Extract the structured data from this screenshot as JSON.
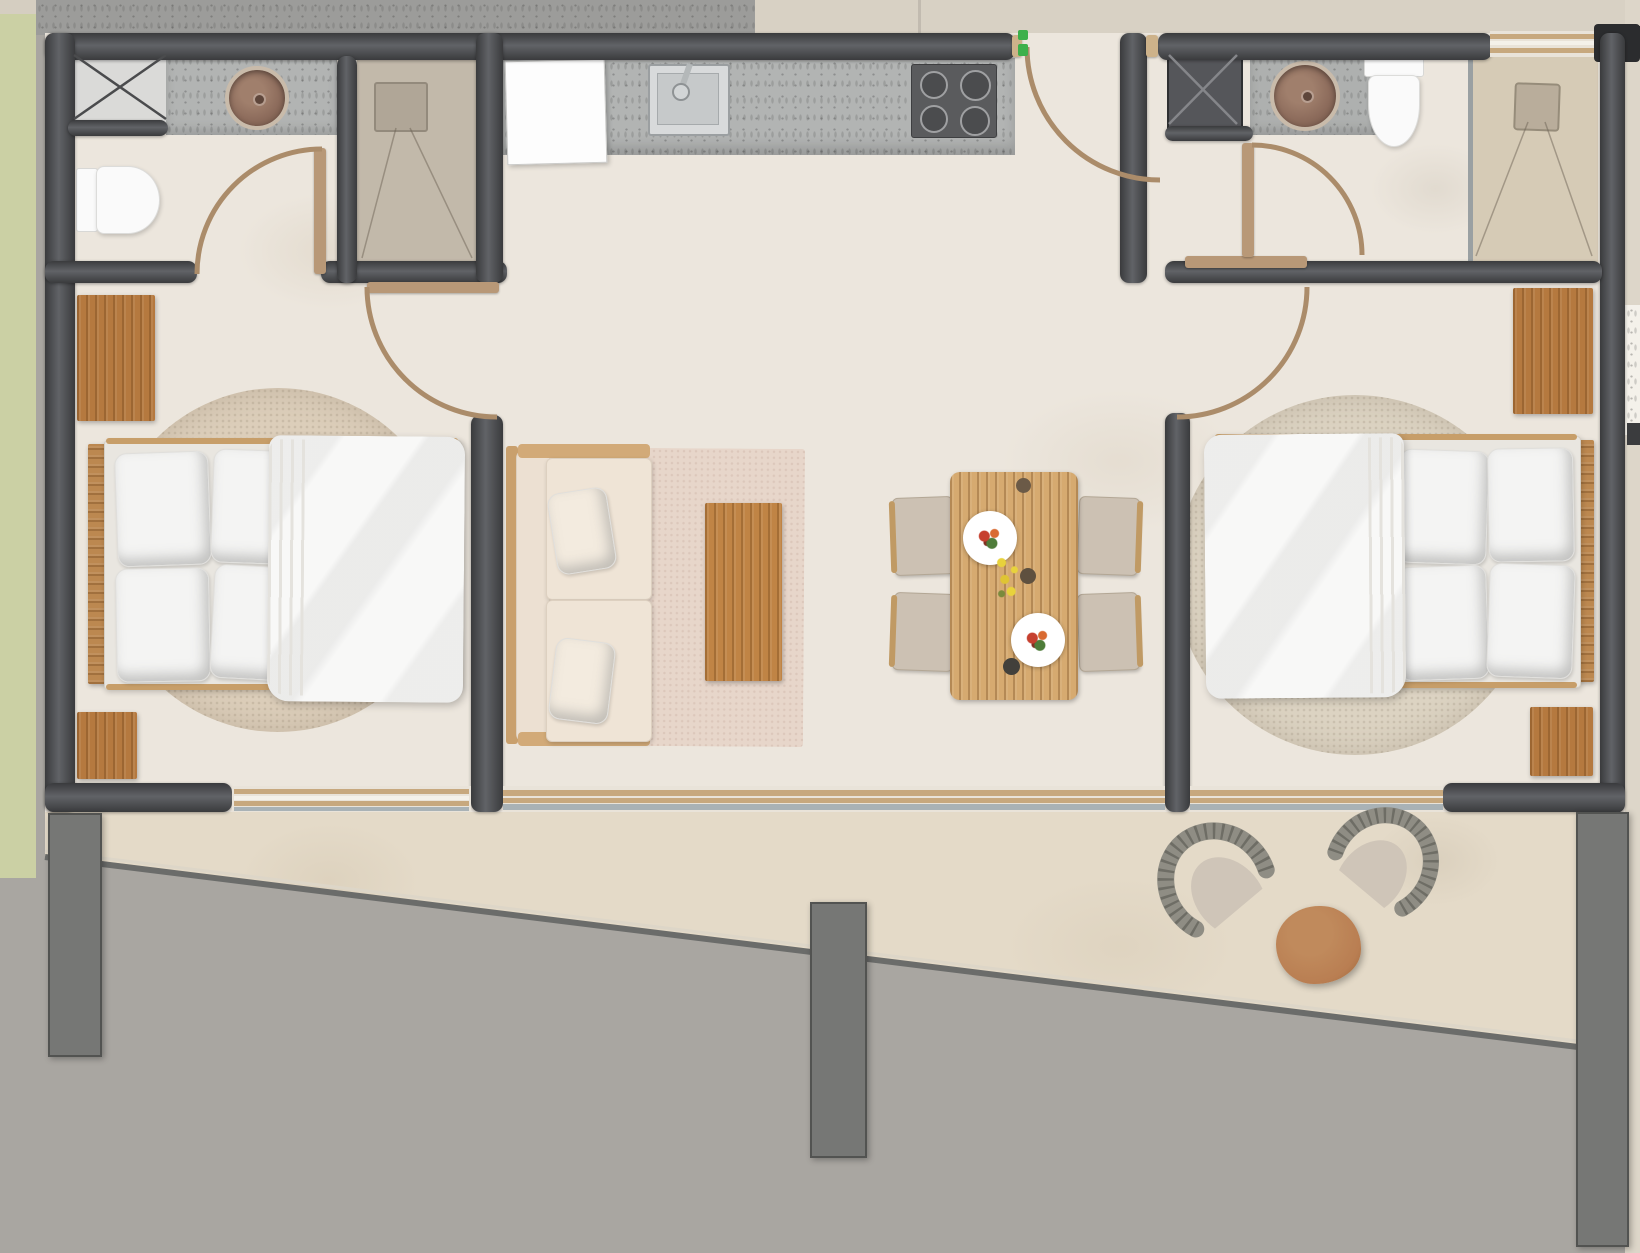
{
  "title": "two-bedroom-apartment-floor-plan",
  "palette": {
    "floor": "#ece6dd",
    "terrace": "#e4dac8",
    "concrete": "#a9a6a1",
    "topConcrete": "#9c9c9a",
    "topBeige": "#d8d1c4",
    "green": "#cbd0a4",
    "wallDark": "#3a3b3d",
    "wallMid": "#616367",
    "wood": "#b5793f",
    "woodLight": "#c9a06d",
    "oak": "#d6aa70",
    "coffeeWood": "#c08445",
    "tan": "#b89877",
    "tanLine": "#ab8c6a",
    "counter": "#b2b4b3",
    "fixtureWhite": "#fafafa",
    "duvet": "#f8f8f7",
    "pillow": "#f4f4f3",
    "mattress": "#e9e6e0",
    "sofa": "#efe4d6",
    "rugLiving": "#e7d6ca",
    "rugBedroom": "#dcceba",
    "basin": "#8d6c5c",
    "basinRim": "#c9bbaa",
    "stove": "#5a5b5d",
    "glass": "#a9b2b6",
    "pillar": "#767775",
    "shaftLight": "#dadad8",
    "shaftDark": "#55565a",
    "shower1": "#c2b9aa",
    "shower2": "#d6cbb6",
    "greenDot": "#3db04b",
    "rightMargin": "#ddd6c9",
    "windowFrame": "#e9e3d9",
    "wicker": "#8f8d84",
    "cushion": "#cfc5b8",
    "terracotta": "#b97e52"
  },
  "rooms": {
    "bedroom_left": {
      "items": [
        "double-bed",
        "headboard",
        "pillows-x4",
        "duvet",
        "round-rug",
        "desk",
        "nightstand",
        "swing-door",
        "window"
      ]
    },
    "bathroom_left": {
      "items": [
        "toilet",
        "vanity-counter",
        "round-basin",
        "service-shaft",
        "swing-door"
      ]
    },
    "shower_room_left": {
      "items": [
        "walk-in-shower",
        "drain"
      ]
    },
    "kitchen": {
      "items": [
        "fridge",
        "counter",
        "sink",
        "faucet",
        "cooktop-4-burners"
      ]
    },
    "living_room": {
      "items": [
        "two-seat-sofa",
        "throw-pillows-x2",
        "coffee-table",
        "area-rug",
        "sliding-glass-door"
      ]
    },
    "dining_area": {
      "items": [
        "dining-table",
        "chairs-x4",
        "plates-x2",
        "cups",
        "flowers"
      ]
    },
    "entry": {
      "items": [
        "entry-door",
        "door-hinge-markers"
      ]
    },
    "bathroom_right": {
      "items": [
        "toilet",
        "vanity-counter",
        "round-basin",
        "service-shaft",
        "walk-in-shower",
        "window",
        "swing-door"
      ]
    },
    "bedroom_right": {
      "items": [
        "double-bed",
        "headboard",
        "pillows-x4",
        "duvet",
        "round-rug",
        "desk",
        "nightstand",
        "swing-door",
        "window"
      ]
    },
    "terrace": {
      "items": [
        "wicker-lounge-chair-x2",
        "round-side-table",
        "concrete-apron",
        "pillars-x3"
      ]
    }
  }
}
